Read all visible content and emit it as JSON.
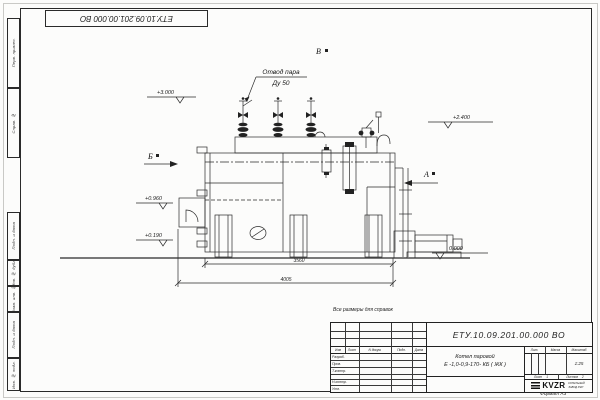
{
  "sheet": {
    "doc_number_top": "ЕТУ.10.09.201.00.000 ВО",
    "reference_note": "Все размеры для справок",
    "format_label": "Формат А3"
  },
  "margin_stamps": [
    "Перв. примен.",
    "Справ. №",
    "Подп. и дата",
    "Инв. № дубл.",
    "Взам. инв. №",
    "Подп. и дата",
    "Инв. № подл."
  ],
  "drawing": {
    "callout_line1": "Отвод пара",
    "callout_line2": "Ду 50",
    "elevations": {
      "e3000": "+3.000",
      "e2400": "+2.400",
      "e0960": "+0.960",
      "e0190": "+0.190",
      "e0000": "0.000"
    },
    "views": {
      "a": "А",
      "b": "Б",
      "v": "В"
    },
    "dimensions": {
      "d3560": "3560",
      "d4005": "4005"
    },
    "line_color": "#2a2a2a"
  },
  "title_block": {
    "doc_number": "ЕТУ.10.09.201.00.000  ВО",
    "product_name_line1": "Котел паровой",
    "product_name_line2": "Е -1,0-0,9-170- КБ ( ЖК )",
    "header_cols": {
      "izm": "Изм",
      "list": "Лист",
      "n_dokum": "N докум.",
      "podp": "Подп.",
      "data": "Дата"
    },
    "rows": [
      "Разраб.",
      "Пров.",
      "Т.контр.",
      "Н.контр.",
      "Утв."
    ],
    "lit_label": "Лит.",
    "massa_label": "Масса",
    "masshtab_label": "Масштаб",
    "scale": "1:25",
    "sheet_label": "Лист",
    "sheet_value": "1",
    "sheets_label": "Листов",
    "sheets_value": "2",
    "company_logo": "KVZR",
    "company_line1": "КОТЕЛЬНЫЙ",
    "company_line2": "ЗАВОД РЭП"
  }
}
